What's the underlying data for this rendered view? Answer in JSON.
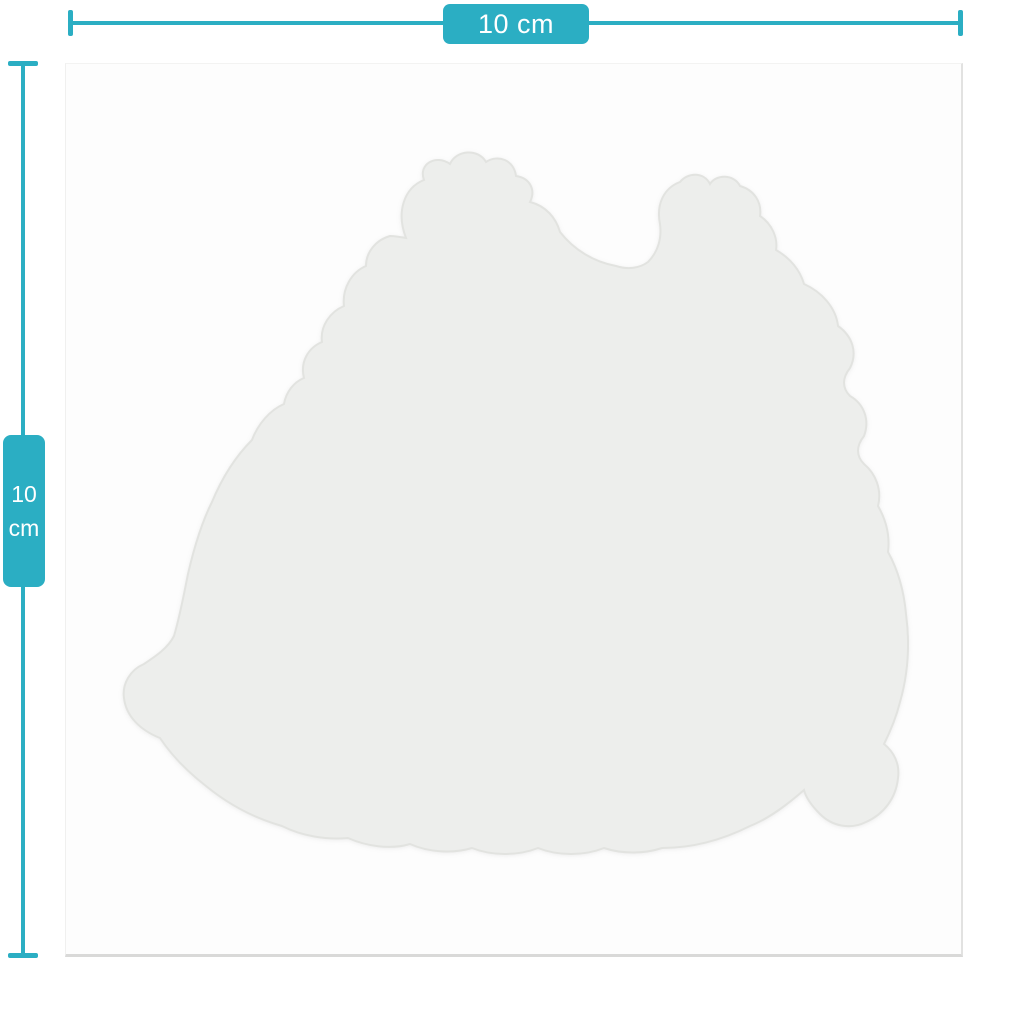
{
  "diagram": {
    "width_dimension": {
      "label": "10 cm"
    },
    "height_dimension": {
      "value": "10",
      "unit": "cm"
    }
  },
  "colors": {
    "accent_teal": "#2BAEC3",
    "label_text": "#FFFFFF",
    "page_background": "#FFFFFF",
    "card_background": "#FDFDFD",
    "sticker_fill": "#EDEEEC",
    "sticker_edge": "#E2E3E0"
  },
  "sticker": {
    "shape": "die-cut-blob-silhouette",
    "path": "M 406 238 C 396 212 404 188 424 180 C 418 164 436 154 450 164 C 456 150 478 148 486 162 C 498 154 514 160 516 176 C 530 178 536 190 530 202 C 546 206 556 218 560 232 C 574 250 594 262 616 266 C 628 270 640 268 648 262 C 658 252 662 238 660 224 C 656 204 664 188 680 182 C 688 172 704 172 710 184 C 716 174 734 174 740 186 C 754 190 762 202 760 216 C 772 224 778 238 776 250 C 790 258 800 270 804 284 C 822 292 836 308 838 326 C 852 336 858 352 850 368 C 842 378 842 388 850 396 C 864 404 870 420 864 436 C 856 446 856 456 864 464 C 876 474 882 490 878 506 C 886 520 890 536 888 552 C 898 570 904 592 906 614 C 910 644 908 674 900 702 C 896 718 890 732 884 744 C 894 752 900 764 898 778 C 896 798 884 814 866 822 C 850 830 832 826 820 814 C 812 806 806 798 804 790 C 788 804 770 818 750 826 C 722 840 692 848 662 848 C 644 854 622 854 604 848 C 584 856 558 856 538 848 C 518 856 492 856 472 848 C 452 854 428 852 410 844 C 390 850 366 846 348 838 C 326 840 302 836 282 826 C 254 818 228 804 206 786 C 188 772 172 756 160 738 C 140 730 126 716 124 698 C 122 684 130 670 144 664 C 156 656 168 648 174 636 C 180 616 184 594 188 574 C 194 548 202 522 212 502 C 222 478 236 456 252 440 C 258 424 270 410 284 404 C 286 392 294 382 304 378 C 300 362 308 348 322 342 C 320 326 330 312 344 306 C 342 288 352 272 366 266 C 366 252 376 240 390 236 C 394 236 400 237 406 238 Z"
  }
}
